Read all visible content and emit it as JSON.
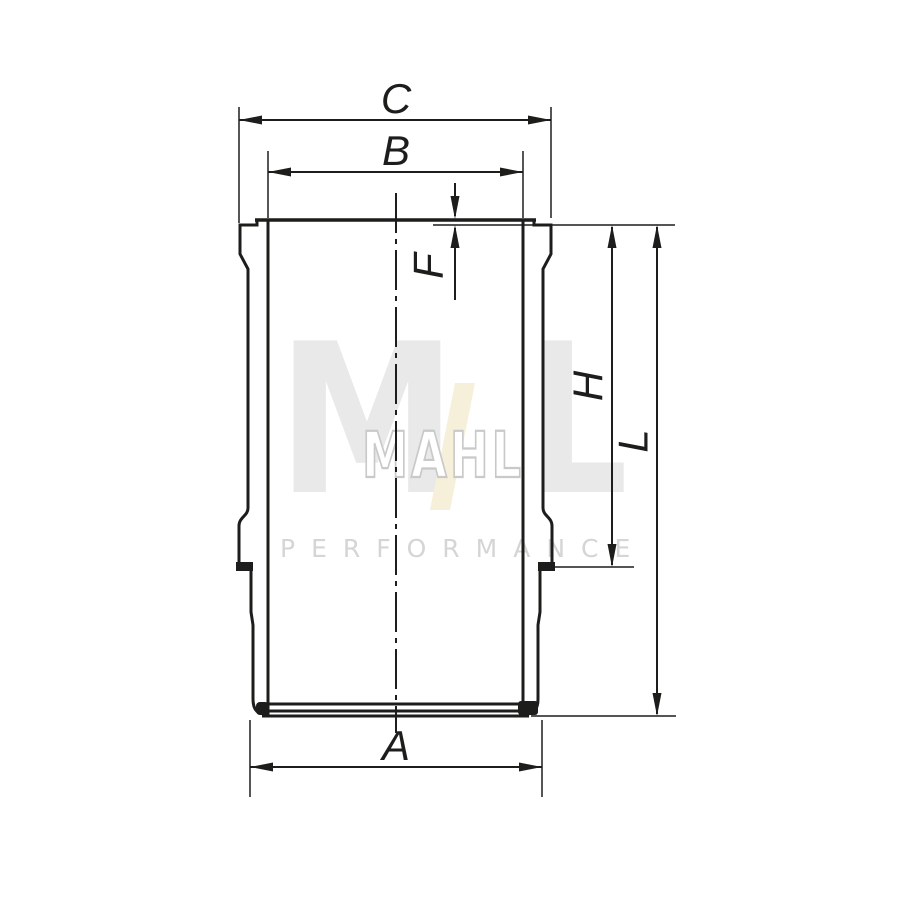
{
  "diagram": {
    "description": "Cylinder liner cross-section technical drawing",
    "dimensions": {
      "a": "A",
      "b": "B",
      "c": "C",
      "f": "F",
      "h": "H",
      "l": "L"
    }
  },
  "watermark": {
    "letter_m": "M",
    "outline_text": "MAHL",
    "letter_l": "L",
    "subtitle": "PERFORMANCE"
  },
  "colors": {
    "background": "#ffffff",
    "line": "#1d1d1b",
    "watermark_gray": "#e9e9e9",
    "watermark_outline": "#c9c9c9",
    "watermark_slash_tan": "#f6efd9",
    "watermark_subtitle": "#d5d5d5"
  }
}
